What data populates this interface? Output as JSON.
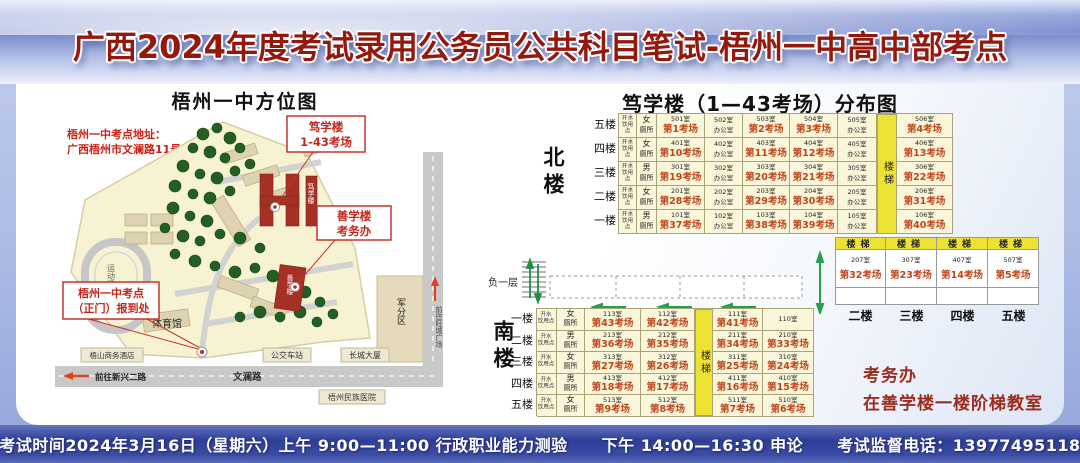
{
  "banner": {
    "title": "广西2024年度考试录用公务员公共科目笔试-梧州一中高中部考点"
  },
  "bottom_bar": {
    "session1": "考试时间2024年3月16日（星期六）上午 9:00—11:00 行政职业能力测验",
    "session2": "下午 14:00—16:30 申论",
    "phone": "考试监督电话：13977495118"
  },
  "map": {
    "title": "梧州一中方位图",
    "address": [
      "梧州一中考点地址：",
      "广西梧州市文澜路11号"
    ],
    "callout_duxue": [
      "笃学楼",
      "1-43考场"
    ],
    "callout_shanxue": [
      "善学楼",
      "考务办"
    ],
    "callout_gate": [
      "梧州一中考点",
      "（正门）报到处"
    ],
    "buildings": {
      "duxue": "笃学楼",
      "shanxue": "善学楼",
      "gym": "体育馆",
      "playground": "运动场",
      "military": "军分区"
    },
    "surroundings": {
      "hotel": "梧山商务酒店",
      "bus": "公交车站",
      "tower": "长城大厦",
      "hospital": "梧州民族医院",
      "road": "文澜路",
      "to_xinxing": "前往新兴二路",
      "to_wangcheng": "前往旺城广场"
    }
  },
  "distribution": {
    "title": "笃学楼（1—43考场）分布图",
    "north_label": "北楼",
    "south_label": "南楼",
    "basement_label": "负一层",
    "stairs": "楼梯",
    "water": [
      "开水",
      "饮用点"
    ],
    "north_rows": [
      {
        "floor": "五楼",
        "toilet": [
          "女",
          "厕所"
        ],
        "cells": [
          [
            "501室",
            "第1考场"
          ],
          [
            "502室",
            "办公室"
          ],
          [
            "503室",
            "第2考场"
          ],
          [
            "504室",
            "第3考场"
          ],
          [
            "505室",
            "办公室"
          ]
        ],
        "last": [
          "506室",
          "第4考场"
        ]
      },
      {
        "floor": "四楼",
        "toilet": [
          "女",
          "厕所"
        ],
        "cells": [
          [
            "401室",
            "第10考场"
          ],
          [
            "402室",
            "办公室"
          ],
          [
            "403室",
            "第11考场"
          ],
          [
            "404室",
            "第12考场"
          ],
          [
            "405室",
            "办公室"
          ]
        ],
        "last": [
          "406室",
          "第13考场"
        ]
      },
      {
        "floor": "三楼",
        "toilet": [
          "男",
          "厕所"
        ],
        "cells": [
          [
            "301室",
            "第19考场"
          ],
          [
            "302室",
            "办公室"
          ],
          [
            "303室",
            "第20考场"
          ],
          [
            "304室",
            "第21考场"
          ],
          [
            "305室",
            "办公室"
          ]
        ],
        "last": [
          "306室",
          "第22考场"
        ]
      },
      {
        "floor": "二楼",
        "toilet": [
          "女",
          "厕所"
        ],
        "cells": [
          [
            "201室",
            "第28考场"
          ],
          [
            "202室",
            "办公室"
          ],
          [
            "203室",
            "第29考场"
          ],
          [
            "204室",
            "第30考场"
          ],
          [
            "205室",
            "办公室"
          ]
        ],
        "last": [
          "206室",
          "第31考场"
        ]
      },
      {
        "floor": "一楼",
        "toilet": [
          "男",
          "厕所"
        ],
        "cells": [
          [
            "101室",
            "第37考场"
          ],
          [
            "102室",
            "办公室"
          ],
          [
            "103室",
            "第38考场"
          ],
          [
            "104室",
            "第39考场"
          ],
          [
            "105室",
            "办公室"
          ]
        ],
        "last": [
          "106室",
          "第40考场"
        ]
      }
    ],
    "wing": {
      "columns": [
        {
          "room": [
            "207室",
            "第32考场"
          ],
          "floor": "二楼"
        },
        {
          "room": [
            "307室",
            "第23考场"
          ],
          "floor": "三楼"
        },
        {
          "room": [
            "407室",
            "第14考场"
          ],
          "floor": "四楼"
        },
        {
          "room": [
            "507室",
            "第5考场"
          ],
          "floor": "五楼"
        }
      ]
    },
    "south_rows": [
      {
        "floor": "一楼",
        "toilet": [
          "女",
          "厕所"
        ],
        "before": [
          [
            "113室",
            "第43考场"
          ],
          [
            "112室",
            "第42考场"
          ]
        ],
        "after": [
          [
            "111室",
            "第41考场"
          ],
          [
            "110室",
            ""
          ]
        ]
      },
      {
        "floor": "二楼",
        "toilet": [
          "男",
          "厕所"
        ],
        "before": [
          [
            "213室",
            "第36考场"
          ],
          [
            "212室",
            "第35考场"
          ]
        ],
        "after": [
          [
            "211室",
            "第34考场"
          ],
          [
            "210室",
            "第33考场"
          ]
        ]
      },
      {
        "floor": "三楼",
        "toilet": [
          "女",
          "厕所"
        ],
        "before": [
          [
            "313室",
            "第27考场"
          ],
          [
            "312室",
            "第26考场"
          ]
        ],
        "after": [
          [
            "311室",
            "第25考场"
          ],
          [
            "310室",
            "第24考场"
          ]
        ]
      },
      {
        "floor": "四楼",
        "toilet": [
          "男",
          "厕所"
        ],
        "before": [
          [
            "413室",
            "第18考场"
          ],
          [
            "412室",
            "第17考场"
          ]
        ],
        "after": [
          [
            "411室",
            "第16考场"
          ],
          [
            "410室",
            "第15考场"
          ]
        ]
      },
      {
        "floor": "五楼",
        "toilet": [
          "女",
          "厕所"
        ],
        "before": [
          [
            "513室",
            "第9考场"
          ],
          [
            "512室",
            "第8考场"
          ]
        ],
        "after": [
          [
            "511室",
            "第7考场"
          ],
          [
            "510室",
            "第6考场"
          ]
        ]
      }
    ],
    "office_note": [
      "考务办",
      "在善学楼一楼阶梯教室"
    ]
  }
}
